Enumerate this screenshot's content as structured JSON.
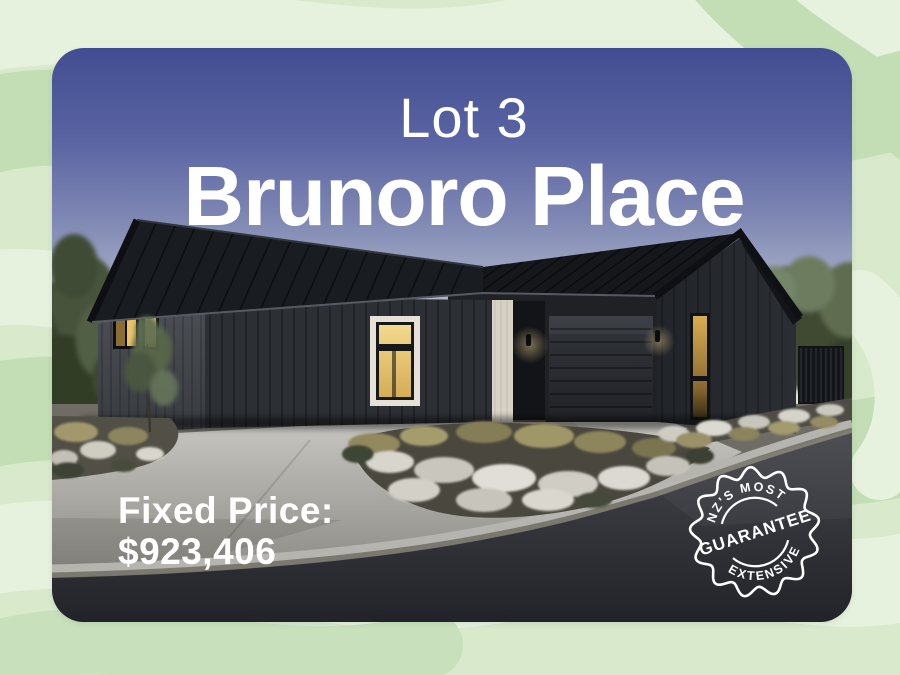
{
  "card": {
    "lot_label": "Lot 3",
    "street_name": "Brunoro Place",
    "price": {
      "label": "Fixed Price:",
      "value": "$923,406"
    },
    "badge": {
      "icon": "guarantee-seal",
      "top_text": "NZ'S MOST",
      "center_text": "GUARANTEE",
      "bottom_text": "EXTENSIVE"
    }
  },
  "colors": {
    "background_green": "#d8e9cc",
    "pattern_green_dark": "#c3ddb5",
    "pattern_green_light": "#e7f2de",
    "sky_top": "#424d91",
    "sky_horizon": "#d8dae2",
    "house_cladding": "#2c2f34",
    "window_glow": "#ecc467",
    "text": "#ffffff",
    "seal": "#ffffff"
  }
}
